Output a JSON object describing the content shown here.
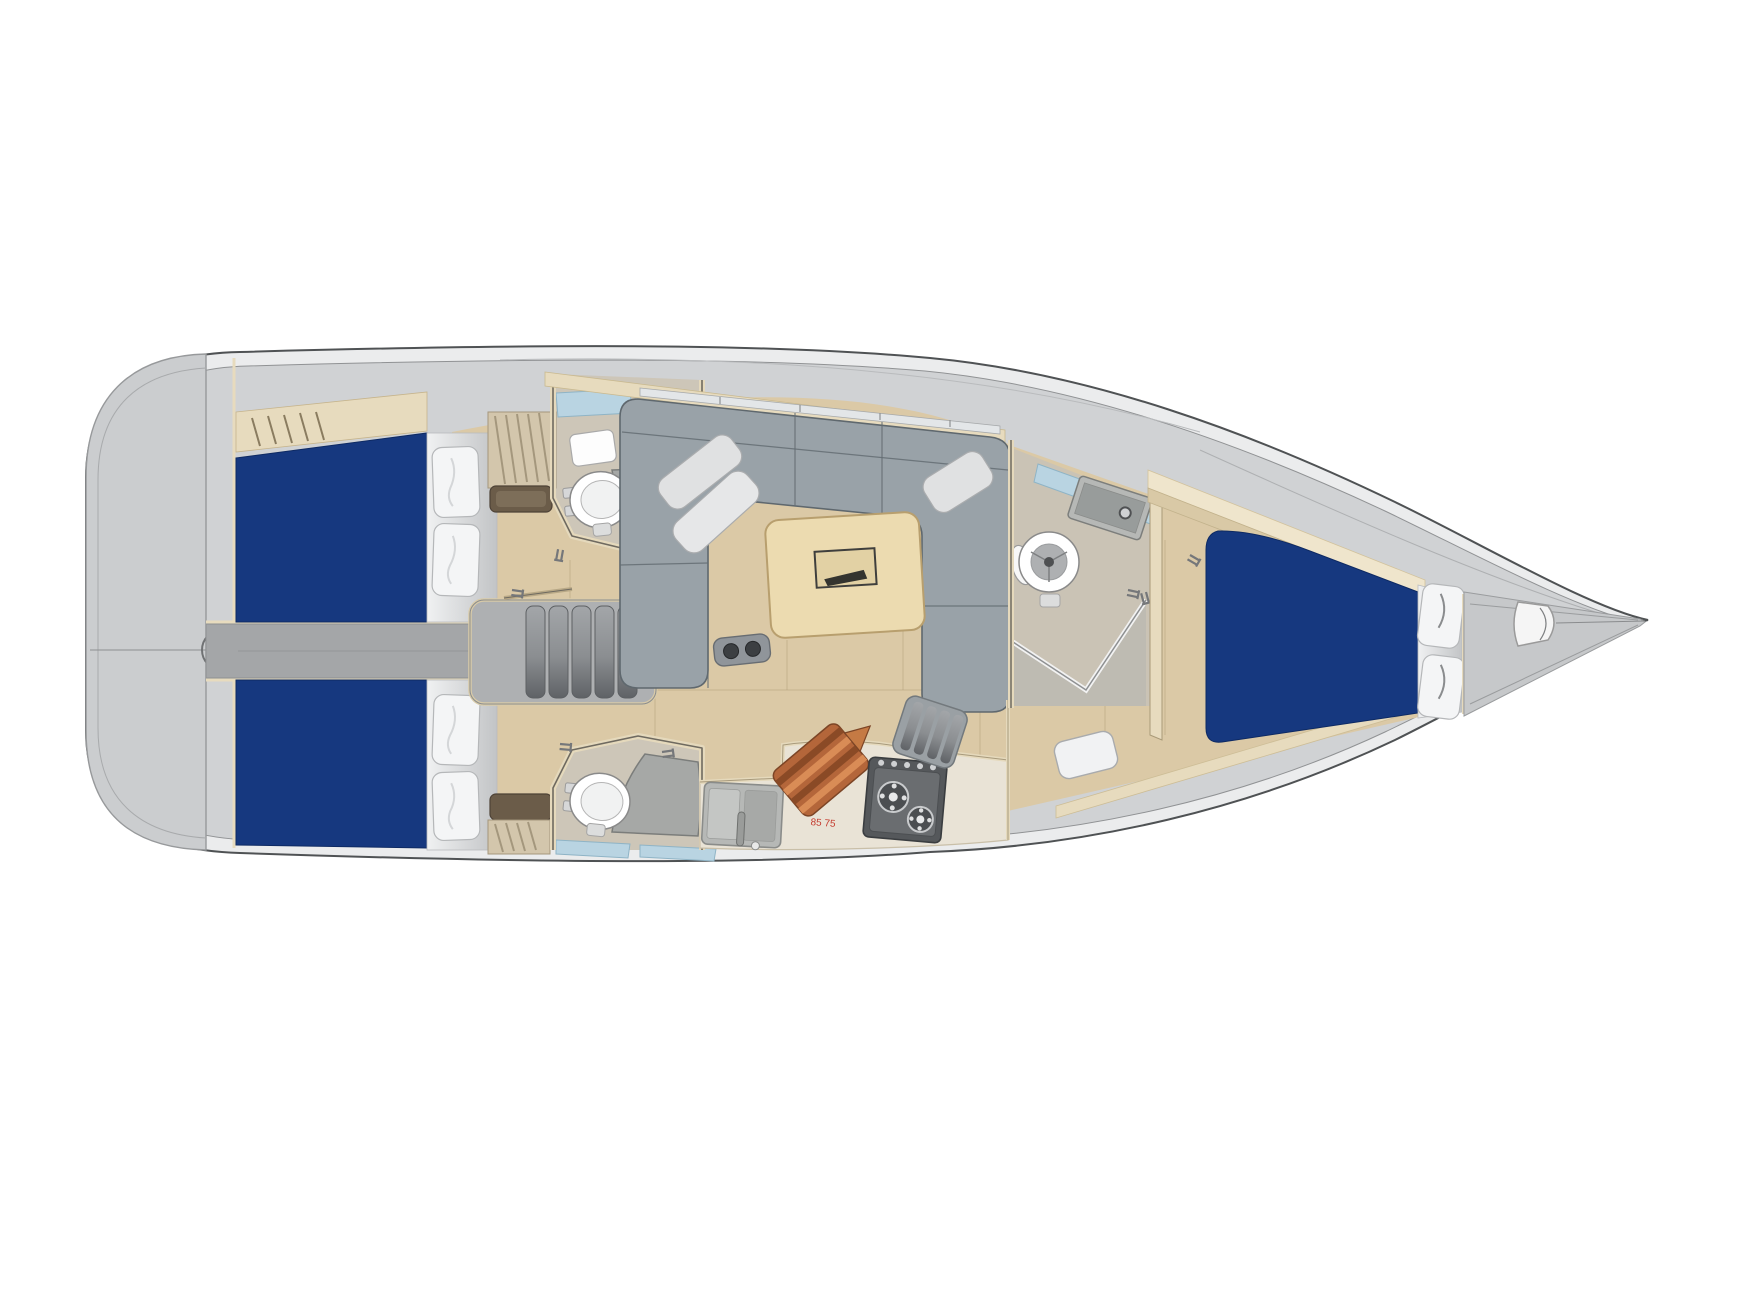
{
  "scene": {
    "type": "yacht-interior-layout-plan",
    "view": "top-down",
    "stern_side": "left",
    "bow_side": "right"
  },
  "annotations": {
    "galley_dimension_label": "85 75"
  },
  "palette": {
    "background": "#ffffff",
    "hull_line": "#4f5254",
    "hull_fill": "#ebeced",
    "deck_gray": "#d0d2d4",
    "transom_gray": "#cbcdcf",
    "corridor_gray": "#a4a6a8",
    "floor_wood": "#dbc9a6",
    "plank_line": "#b39e7c",
    "trim_cream": "#e7dbbe",
    "bed_navy": "#16387f",
    "pillow_white": "#f4f5f6",
    "sofa_gray": "#99a2a8",
    "sofa_seam": "#646d73",
    "table_wood": "#ecdbb0",
    "counter_cream": "#e9e3d6",
    "appliance_gray": "#b6b8b6",
    "stove_dark": "#55585b",
    "cutting_board_wood": "#b4663a",
    "window_blue": "#b9d4e2",
    "fixture_white": "#ffffff",
    "dimension_red": "#c43b2e"
  },
  "areas": [
    {
      "name": "transom-swim-platform",
      "items": [
        "steering-circle",
        "centerline"
      ]
    },
    {
      "name": "aft-cabin-port",
      "items": [
        "double-berth",
        "pillows",
        "shelf-trim",
        "hanging-locker"
      ]
    },
    {
      "name": "aft-head-port",
      "items": [
        "toilet",
        "washbasin",
        "shower-bench",
        "bath-mat",
        "hull-window"
      ]
    },
    {
      "name": "companionway",
      "items": [
        "stairs-5-steps",
        "engine-compartment-corridor",
        "grab-rail"
      ]
    },
    {
      "name": "saloon",
      "items": [
        "l-shaped-sofa",
        "throw-pillows",
        "dining-table",
        "table-inlay",
        "magazine-bracket",
        "coachroof-window"
      ]
    },
    {
      "name": "galley",
      "items": [
        "double-sink",
        "faucet",
        "counter",
        "cutting-board",
        "two-burner-stove",
        "floor-grate"
      ]
    },
    {
      "name": "aft-cabin-starboard",
      "items": [
        "double-berth",
        "pillows",
        "shelf-trim",
        "hanging-locker"
      ]
    },
    {
      "name": "aft-head-starboard",
      "items": [
        "toilet",
        "shower-bench",
        "locker",
        "hull-window"
      ]
    },
    {
      "name": "forward-head",
      "items": [
        "toilet",
        "washbasin",
        "shower-glass-partition",
        "hull-window"
      ]
    },
    {
      "name": "forward-cabin",
      "items": [
        "island-berth",
        "pillows",
        "entry-step",
        "hull-shelves"
      ]
    },
    {
      "name": "bow",
      "items": [
        "anchor-locker",
        "stem-fitting",
        "forestay-line"
      ]
    }
  ]
}
